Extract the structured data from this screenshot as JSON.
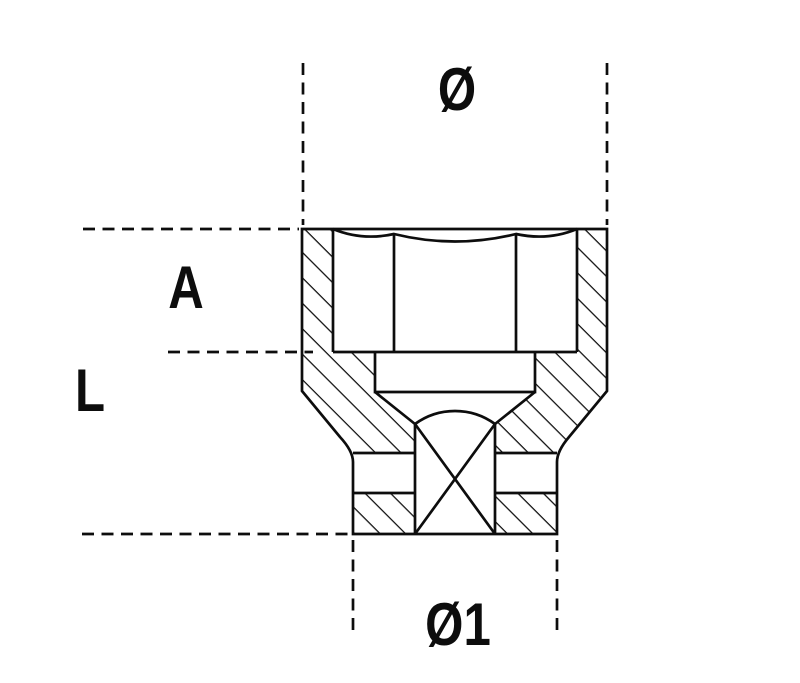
{
  "drawing": {
    "background_color": "#ffffff",
    "line_color": "#0d0d0d",
    "labels": {
      "outer_diameter": "Ø",
      "head_depth": "A",
      "overall_length": "L",
      "drive_end_diameter": "Ø1"
    }
  }
}
